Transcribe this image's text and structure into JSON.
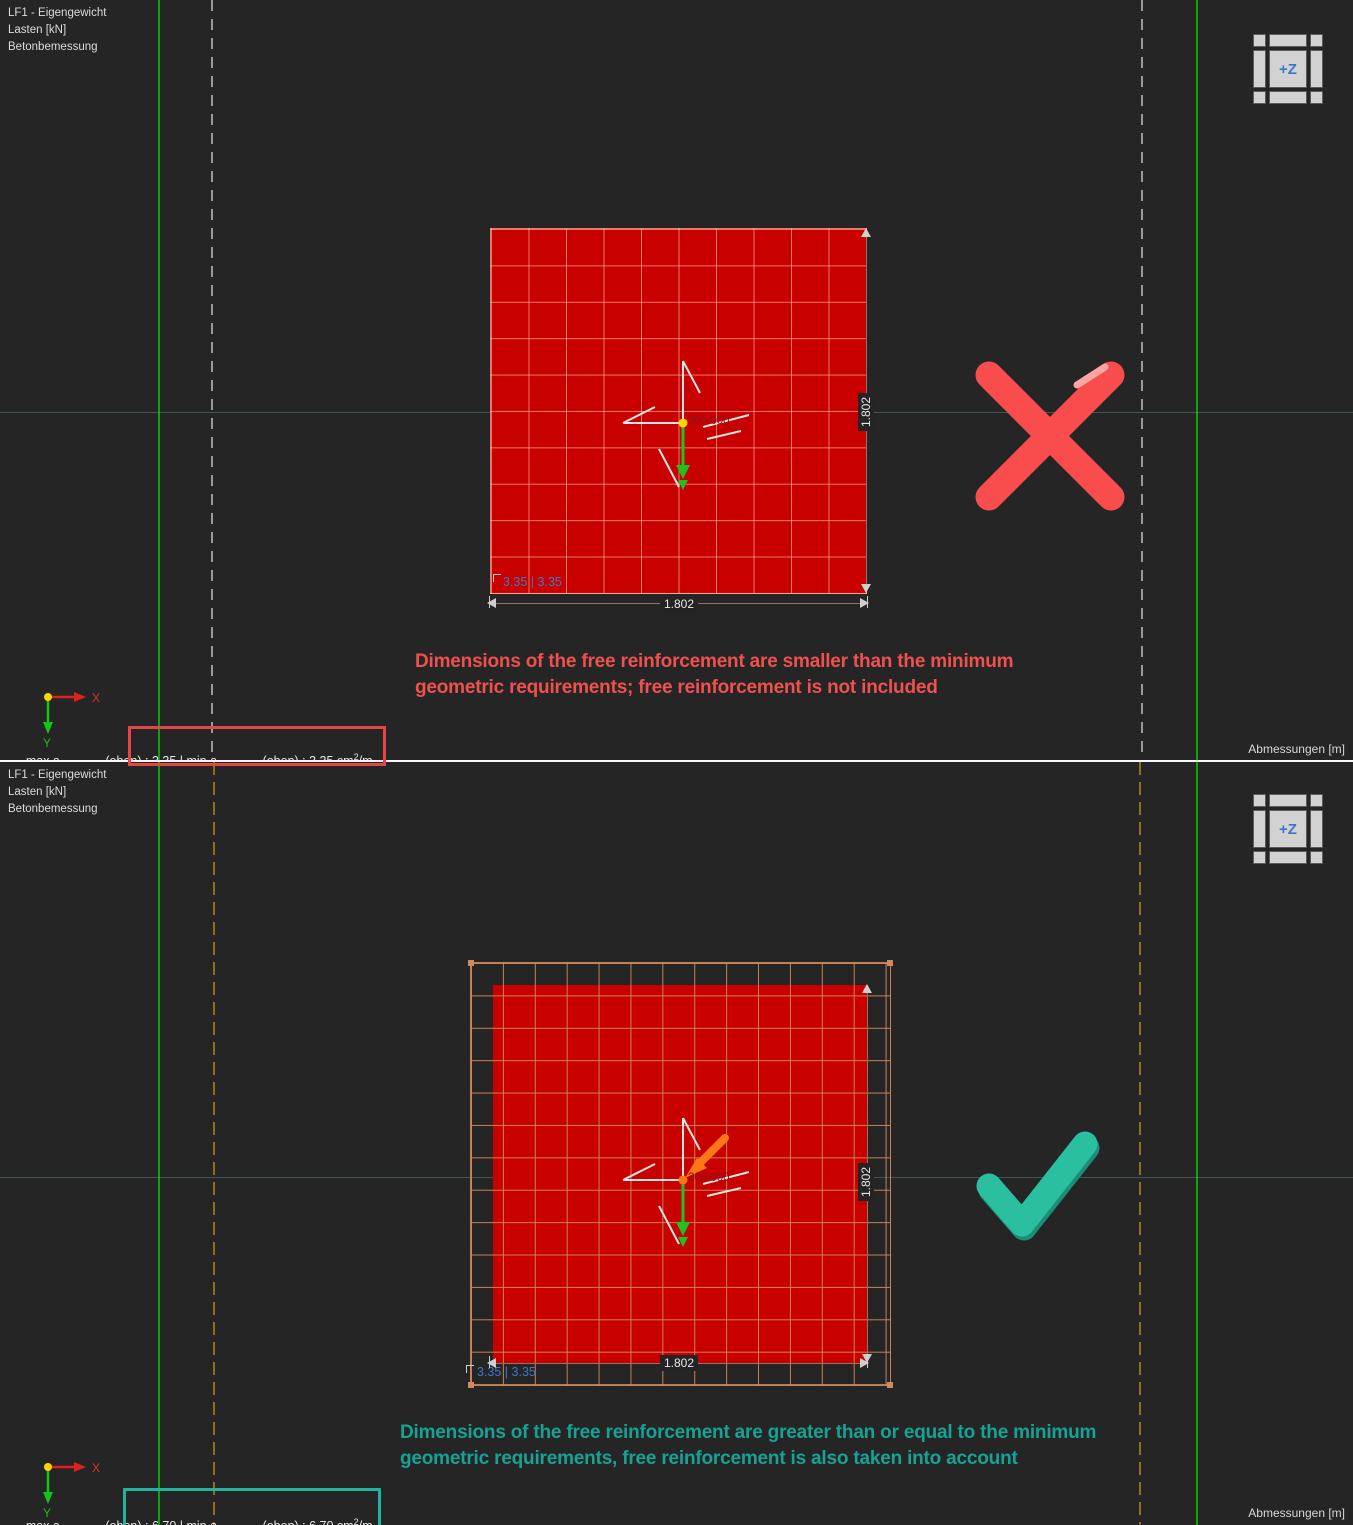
{
  "colors": {
    "background": "#252525",
    "plate_red": "#c80000",
    "grid_tan": "#cd875a",
    "line_green": "#0ca40c",
    "dashed_gray": "#9a9a9a",
    "dashed_yellow": "#8e6f1e",
    "annotation_red": "#f0504e",
    "annotation_teal": "#16a294",
    "highlight_red": "#e64545",
    "highlight_teal": "#1fb3a0",
    "x_mark_red": "#f94d4d",
    "checkmark_teal": "#2abf9f",
    "navcube_label_blue": "#3a76cc",
    "corner_label_blue": "#3b78c9"
  },
  "panels": [
    {
      "info_lines": [
        "LF1 - Eigengewicht",
        "Lasten [kN]",
        "Betonbemessung"
      ],
      "nav_cube_label": "+Z",
      "load_value": "300.000",
      "corner_label": "3.35 | 3.35",
      "dim_width": "1.802",
      "dim_height": "1.802",
      "axis_x": "X",
      "axis_y": "Y",
      "annotation_line1": "Dimensions of the free reinforcement are smaller than the minimum",
      "annotation_line2": "geometric requirements; free reinforcement is not included",
      "status": {
        "max_prefix": "max a",
        "subscript": "s,vorh,1,-z",
        "oben_colon": " (oben) : ",
        "max_value": "3.35",
        "pipe": " | ",
        "min_prefix": "min a",
        "min_value": "3.35",
        "unit_base": " cm",
        "unit_exp": "2",
        "unit_per": "/m"
      },
      "bottom_right_label": "Abmessungen [m]"
    },
    {
      "info_lines": [
        "LF1 - Eigengewicht",
        "Lasten [kN]",
        "Betonbemessung"
      ],
      "nav_cube_label": "+Z",
      "load_value": "300.000",
      "corner_label": "3.35 | 3.35",
      "dim_width": "1.802",
      "dim_height": "1.802",
      "axis_x": "X",
      "axis_y": "Y",
      "annotation_line1": "Dimensions of the free reinforcement are greater than or equal to the minimum",
      "annotation_line2": "geometric requirements, free reinforcement is also taken into account",
      "status": {
        "max_prefix": "max a",
        "subscript": "s,vorh,1,-z",
        "oben_colon": " (oben) : ",
        "max_value": "6.70",
        "pipe": " | ",
        "min_prefix": "min a",
        "min_value": "6.70",
        "unit_base": " cm",
        "unit_exp": "2",
        "unit_per": "/m"
      },
      "bottom_right_label": "Abmessungen [m]"
    }
  ]
}
